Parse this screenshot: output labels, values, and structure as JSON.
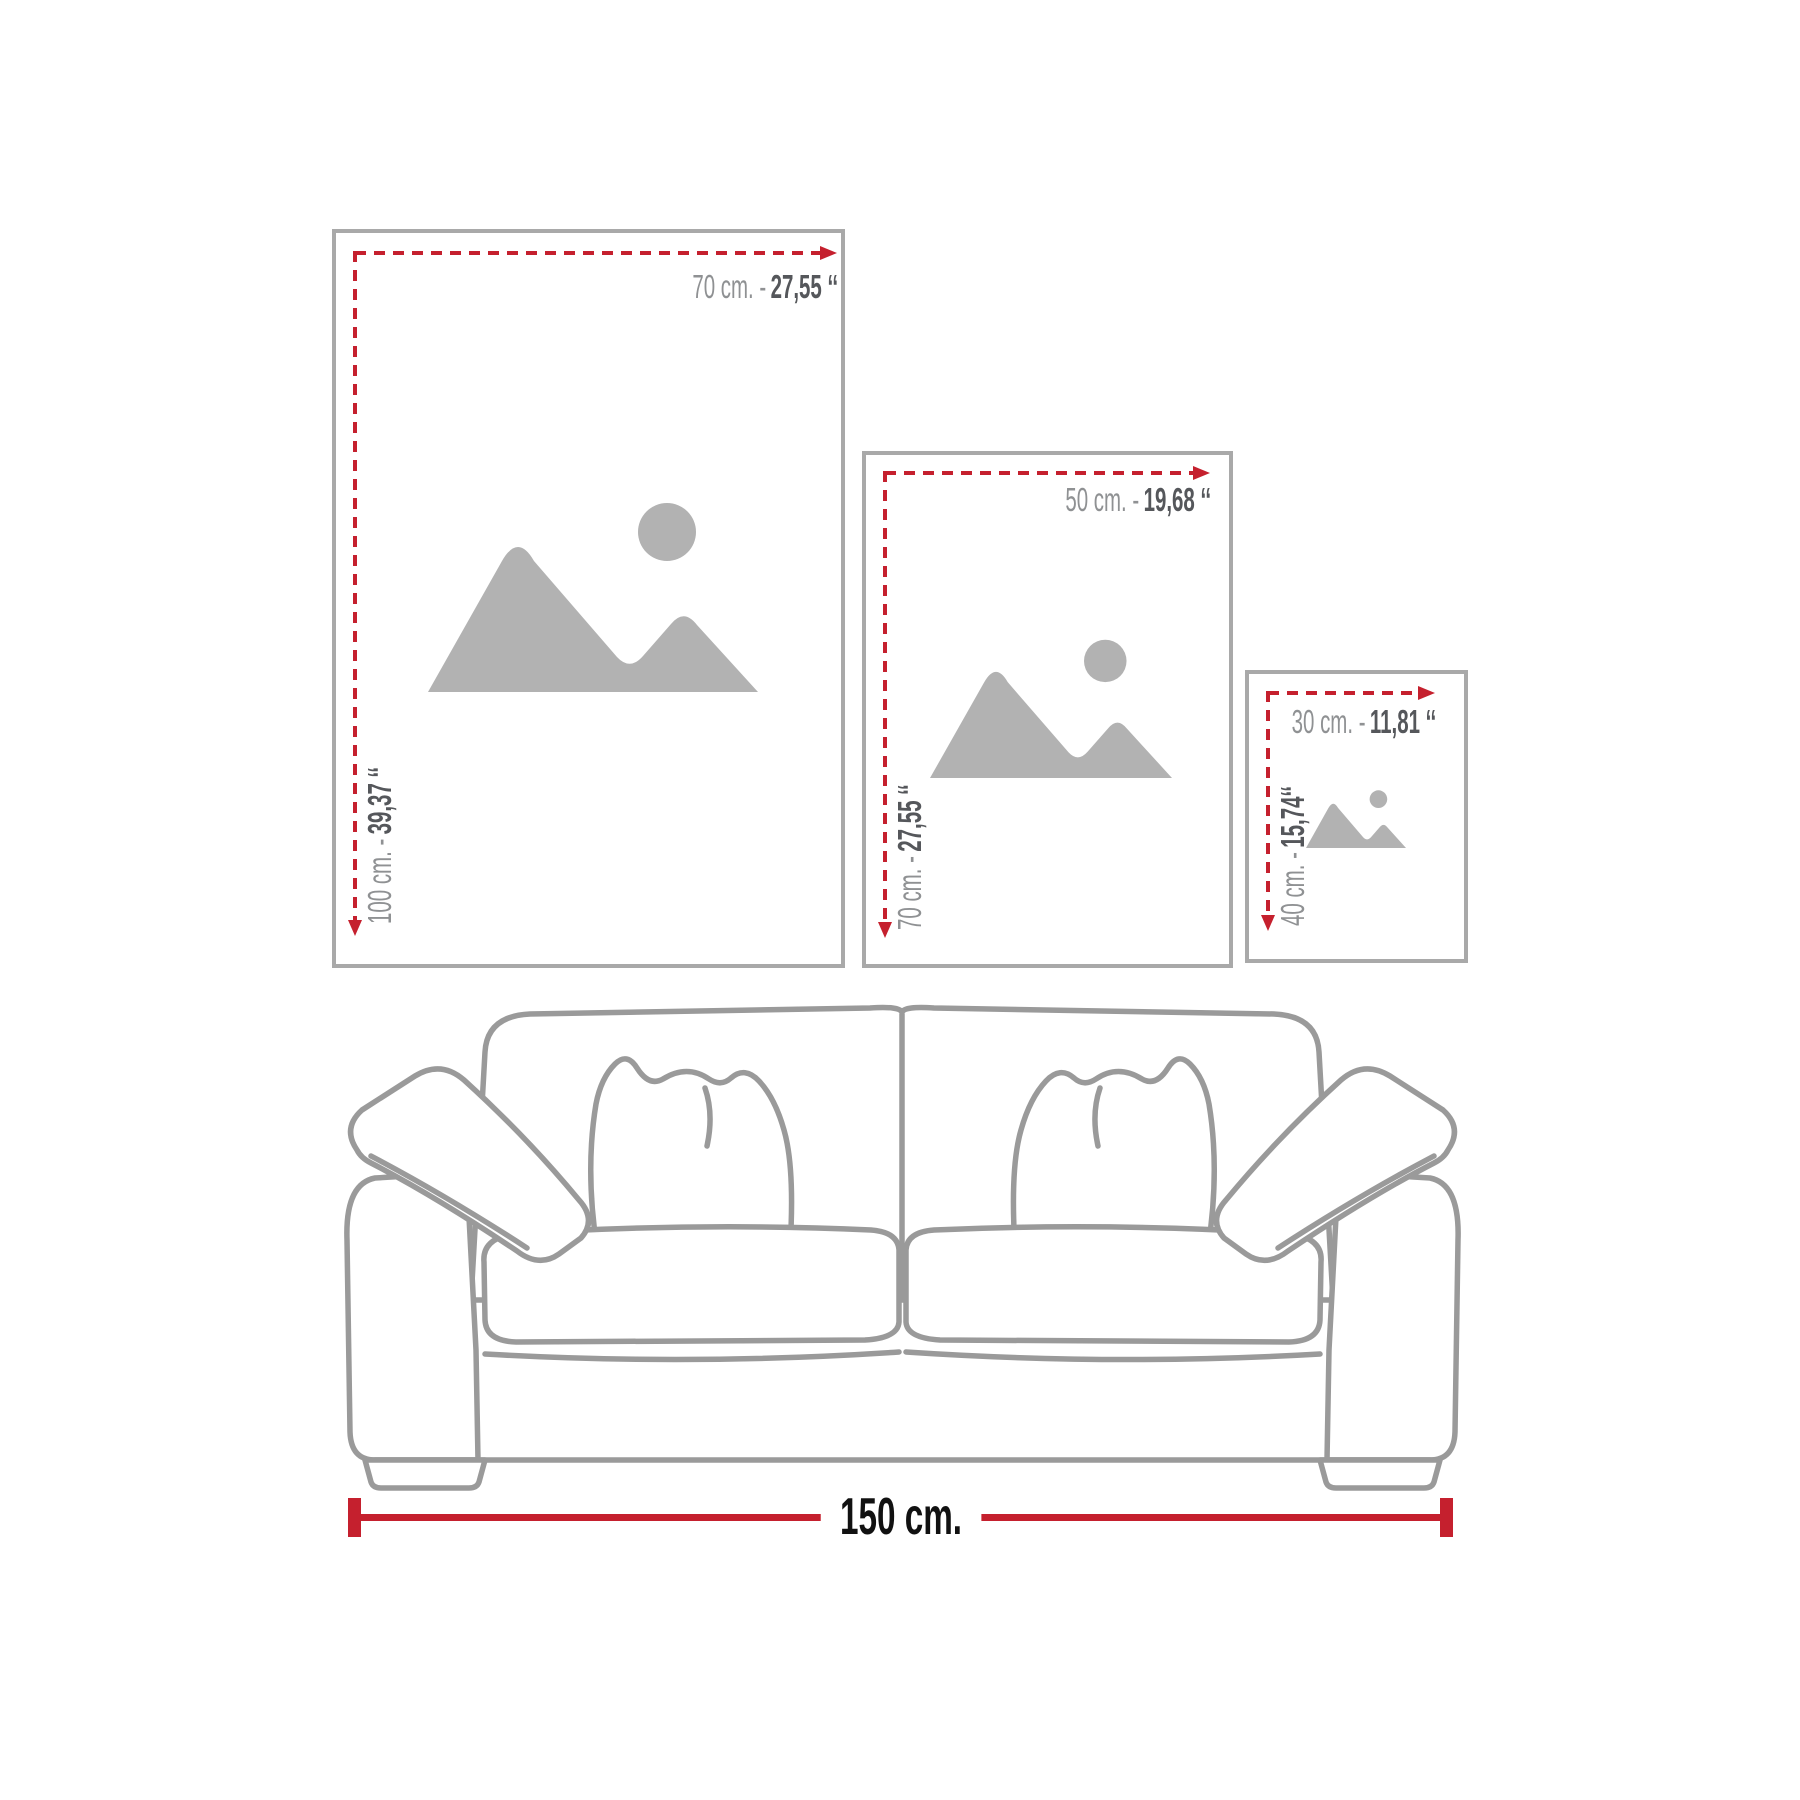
{
  "colors": {
    "accent_red": "#c5202e",
    "frame_border": "#a9a9a9",
    "placeholder_gray": "#b2b2b2",
    "sofa_line": "#9a9a9a",
    "label_metric_gray": "#8f9193",
    "label_imperial_dark": "#55575b",
    "measure_text": "#111111"
  },
  "frames": [
    {
      "name": "frame-70x100",
      "width_metric": "70 cm. -",
      "width_imperial": "27,55 ‘‘",
      "height_metric": "100 cm. -",
      "height_imperial": "39,37 ‘‘"
    },
    {
      "name": "frame-50x70",
      "width_metric": "50 cm. -",
      "width_imperial": "19,68 ‘‘",
      "height_metric": "70 cm. -",
      "height_imperial": "27,55 ‘‘"
    },
    {
      "name": "frame-30x40",
      "width_metric": "30 cm. -",
      "width_imperial": "11,81 ‘‘",
      "height_metric": "40 cm. -",
      "height_imperial": "15,74‘‘"
    }
  ],
  "sofa": {
    "width_label": "150 cm."
  }
}
